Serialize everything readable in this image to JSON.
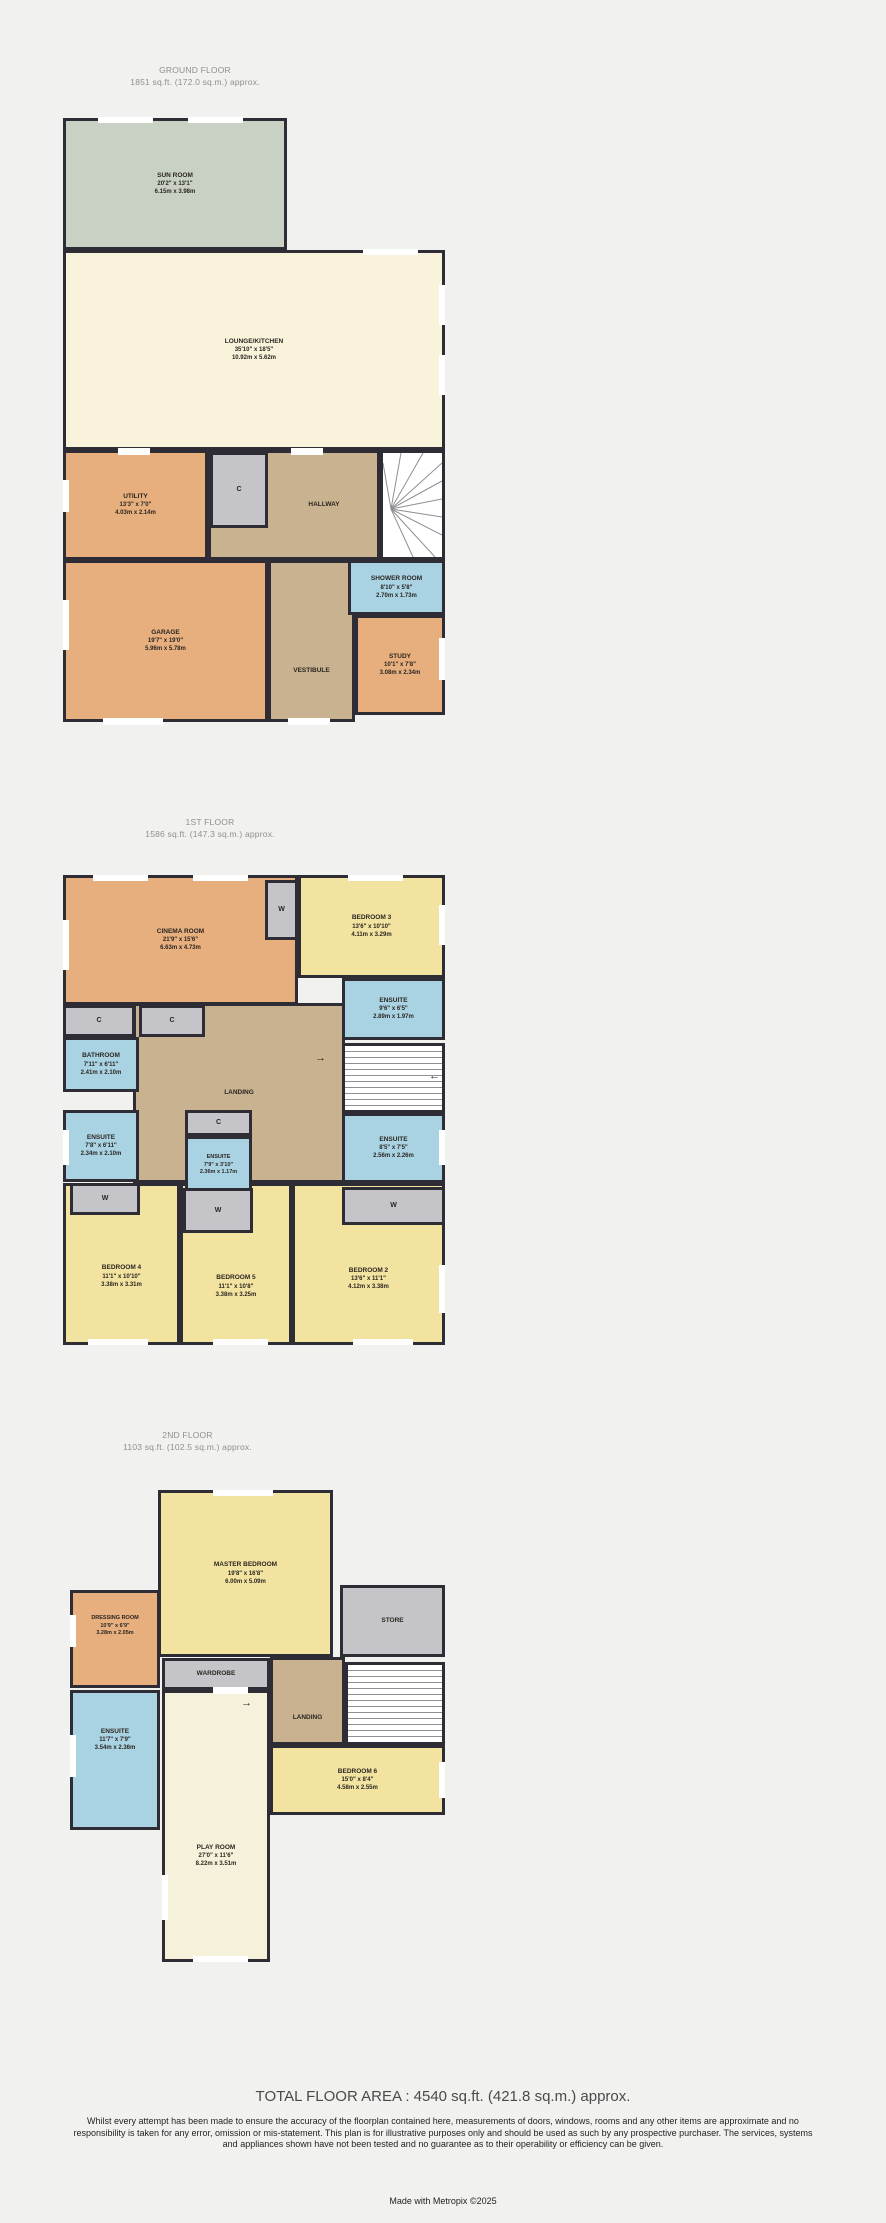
{
  "floors": [
    {
      "title": "GROUND FLOOR",
      "area": "1851 sq.ft. (172.0 sq.m.) approx.",
      "rooms": [
        {
          "name": "SUN ROOM",
          "dims_ft": "20'2\" x 13'1\"",
          "dims_m": "6.15m x 3.98m"
        },
        {
          "name": "LOUNGE/KITCHEN",
          "dims_ft": "35'10\" x 18'5\"",
          "dims_m": "10.92m x 5.62m"
        },
        {
          "name": "UTILITY",
          "dims_ft": "13'3\" x 7'0\"",
          "dims_m": "4.03m x 2.14m"
        },
        {
          "name": "C"
        },
        {
          "name": "HALLWAY"
        },
        {
          "name": "GARAGE",
          "dims_ft": "19'7\" x 19'0\"",
          "dims_m": "5.96m x 5.78m"
        },
        {
          "name": "VESTIBULE"
        },
        {
          "name": "SHOWER ROOM",
          "dims_ft": "8'10\" x 5'8\"",
          "dims_m": "2.70m x 1.73m"
        },
        {
          "name": "STUDY",
          "dims_ft": "10'1\" x 7'8\"",
          "dims_m": "3.08m x 2.34m"
        }
      ]
    },
    {
      "title": "1ST FLOOR",
      "area": "1586 sq.ft. (147.3 sq.m.) approx.",
      "rooms": [
        {
          "name": "CINEMA ROOM",
          "dims_ft": "21'9\" x 15'6\"",
          "dims_m": "6.63m x 4.73m"
        },
        {
          "name": "W"
        },
        {
          "name": "BEDROOM 3",
          "dims_ft": "13'6\" x 10'10\"",
          "dims_m": "4.11m x 3.29m"
        },
        {
          "name": "ENSUITE",
          "dims_ft": "9'6\" x 6'5\"",
          "dims_m": "2.89m x 1.97m"
        },
        {
          "name": "C"
        },
        {
          "name": "C"
        },
        {
          "name": "BATHROOM",
          "dims_ft": "7'11\" x 6'11\"",
          "dims_m": "2.41m x 2.10m"
        },
        {
          "name": "LANDING"
        },
        {
          "name": "ENSUITE",
          "dims_ft": "7'8\" x 6'11\"",
          "dims_m": "2.34m x 2.10m"
        },
        {
          "name": "C"
        },
        {
          "name": "ENSUITE",
          "dims_ft": "7'9\" x 3'10\"",
          "dims_m": "2.36m x 1.17m"
        },
        {
          "name": "ENSUITE",
          "dims_ft": "8'5\" x 7'5\"",
          "dims_m": "2.56m x 2.26m"
        },
        {
          "name": "W"
        },
        {
          "name": "W"
        },
        {
          "name": "W"
        },
        {
          "name": "BEDROOM 4",
          "dims_ft": "11'1\" x 10'10\"",
          "dims_m": "3.38m x 3.31m"
        },
        {
          "name": "BEDROOM 5",
          "dims_ft": "11'1\" x 10'8\"",
          "dims_m": "3.38m x 3.25m"
        },
        {
          "name": "BEDROOM 2",
          "dims_ft": "13'6\" x 11'1\"",
          "dims_m": "4.12m x 3.38m"
        }
      ]
    },
    {
      "title": "2ND FLOOR",
      "area": "1103 sq.ft. (102.5 sq.m.) approx.",
      "rooms": [
        {
          "name": "MASTER BEDROOM",
          "dims_ft": "19'8\" x 16'8\"",
          "dims_m": "6.00m x 5.09m"
        },
        {
          "name": "DRESSING ROOM",
          "dims_ft": "10'9\" x 6'9\"",
          "dims_m": "3.28m x 2.05m"
        },
        {
          "name": "WARDROBE"
        },
        {
          "name": "ENSUITE",
          "dims_ft": "11'7\" x 7'9\"",
          "dims_m": "3.54m x 2.36m"
        },
        {
          "name": "STORE"
        },
        {
          "name": "LANDING"
        },
        {
          "name": "BEDROOM 6",
          "dims_ft": "15'0\" x 8'4\"",
          "dims_m": "4.58m x 2.55m"
        },
        {
          "name": "PLAY ROOM",
          "dims_ft": "27'0\" x 11'6\"",
          "dims_m": "8.22m x 3.51m"
        }
      ]
    }
  ],
  "icons": {
    "arrow_right": "→",
    "arrow_left": "←"
  },
  "colors": {
    "wall": "#2e2d35",
    "sun_room": "#c8d1c3",
    "living": "#f8f3da",
    "service": "#e7ae7e",
    "hall": "#c8b28f",
    "wet_room": "#a9d3e2",
    "bedroom": "#f3e3a1",
    "storage": "#c4c4c9"
  },
  "footer": {
    "total": "TOTAL FLOOR AREA : 4540 sq.ft. (421.8 sq.m.) approx.",
    "disclaimer": "Whilst every attempt has been made to ensure the accuracy of the floorplan contained here, measurements of doors, windows, rooms and any other items are approximate and no responsibility is taken for any error, omission or mis-statement. This plan is for illustrative purposes only and should be used as such by any prospective purchaser. The services, systems and appliances shown have not been tested and no guarantee as to their operability or efficiency can be given.",
    "credit": "Made with Metropix ©2025"
  }
}
